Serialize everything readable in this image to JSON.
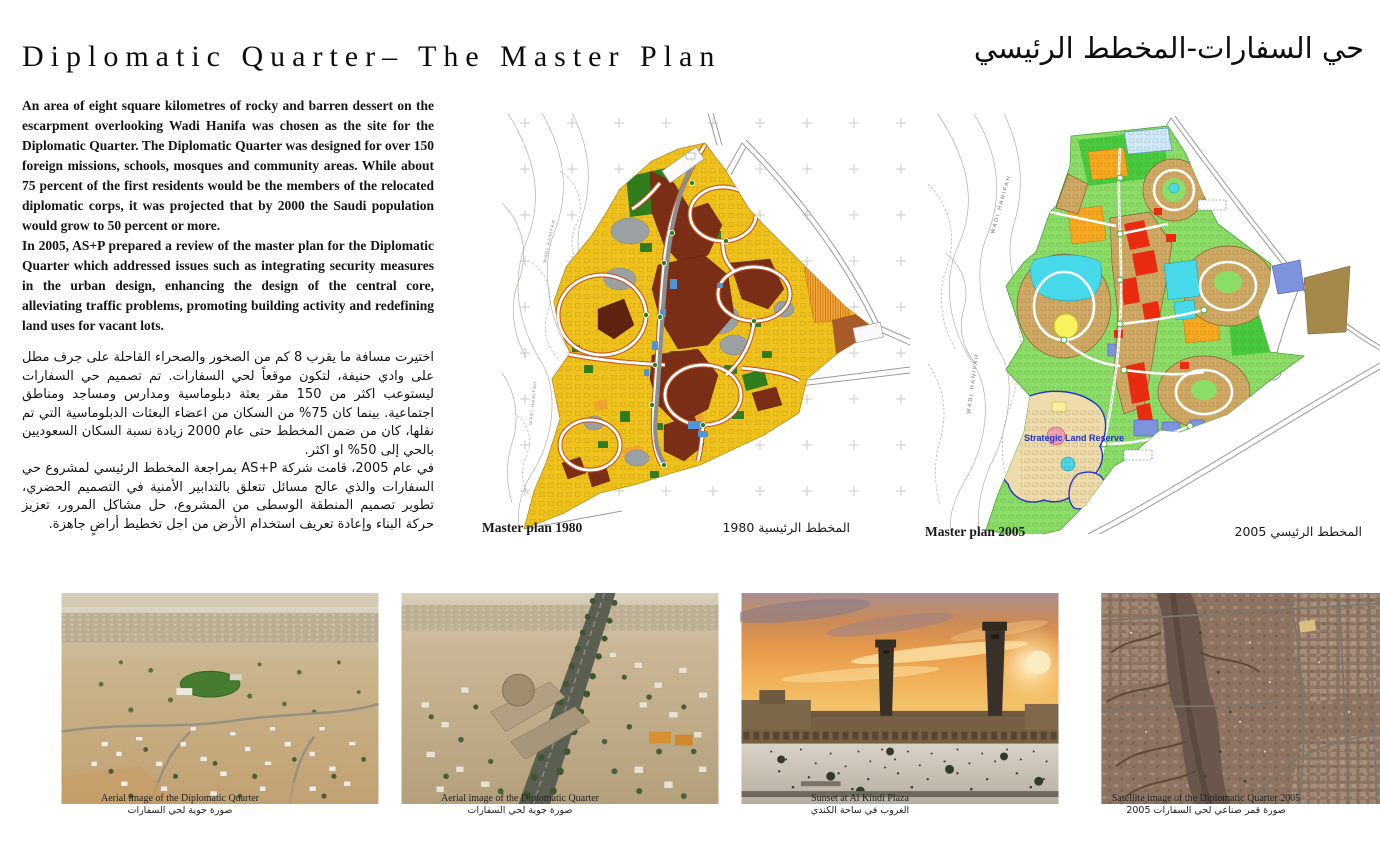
{
  "header": {
    "title_en": "Diplomatic Quarter– The Master Plan",
    "title_ar": "حي السفارات-المخطط الرئيسي"
  },
  "intro": {
    "p_en_1": "An area of eight square kilometres of rocky and barren dessert on the escarpment overlooking Wadi Hanifa was chosen as the site for the Diplomatic Quarter. The Diplomatic Quarter was designed for over 150 foreign missions, schools, mosques and community areas. While about 75 percent of the first residents would be the members of the relocated diplomatic corps, it was projected that by 2000 the Saudi population would grow to 50 percent or more.",
    "p_en_2": "In 2005, AS+P prepared a review of the master plan for the Diplomatic Quarter which addressed issues such as integrating security measures in the urban design, enhancing the design of the central core, alleviating traffic problems, promoting building activity and redefining land uses for vacant lots.",
    "p_ar_1": "اختيرت مسافة ما يقرب 8 كم من الصخور والصحراء القاحلة على جرف مطل على وادي حنيفة، لتكون موقعاً لحي السفارات. تم تصميم حي السفارات ليستوعب اكثر من 150 مقر بعثة دبلوماسية ومدارس ومساجد ومناطق اجتماعية. بينما كان 75% من السكان من اعضاء البعثات الدبلوماسية التي تم نقلها، كان من ضمن المخطط حتى عام 2000 زيادة نسبة السكان السعوديين بالحي إلى 50% او اكثر.",
    "p_ar_2": "في عام 2005، قامت شركة AS+P بمراجعة المخطط الرئيسي لمشروع حي السفارات والذي عالج مسائل تتعلق بالتدابير الأمنية في التصميم الحضري، تطوير تصميم المنطقة الوسطى من المشروع، حل مشاكل المرور، تعزيز حركة البناء وإعادة تعريف استخدام الأرض من اجل تخطيط أراضٍ جاهزة."
  },
  "maps": [
    {
      "caption_en": "Master plan 1980",
      "caption_ar": "المخطط الرئيسية 1980",
      "wadi_label": "WADI HANIFAH"
    },
    {
      "caption_en": "Master plan 2005",
      "caption_ar": "المخطط الرئيسي 2005",
      "wadi_label": "WADI HANIFAH",
      "annotation": "Strategic Land Reserve"
    }
  ],
  "photos": [
    {
      "caption_en": "Aerial image of the Diplomatic Quarter",
      "caption_ar": "صورة جوية لحي السفارات"
    },
    {
      "caption_en": "Aerial image of the Diplomatic Quarter",
      "caption_ar": "صورة جوية لحي السفارات"
    },
    {
      "caption_en": "Sunset at Al Kindi Plaza",
      "caption_ar": "الغروب في ساحة الكندي"
    },
    {
      "caption_en": "Satellite image of the Diplomatic Quarter 2005",
      "caption_ar": "صورة قمر صناعي لحي السفارات 2005"
    }
  ],
  "colors": {
    "plan1980_residential_yellow": "#eec11d",
    "plan1980_blocks_maroon": "#7a2e15",
    "plan1980_parks_green": "#2f7d1d",
    "plan1980_institution_gray": "#9ba1a3",
    "plan1980_ringroad_red": "#c24e1d",
    "plan2005_open_green": "#8ade68",
    "plan2005_blocks_tan": "#cfa964",
    "plan2005_core_red": "#e92b12",
    "plan2005_water_cyan": "#45d9e9",
    "plan2005_orange": "#f7a81f",
    "strategic_reserve_blue": "#2233cc",
    "sunset_orange": "#e89a4a"
  }
}
